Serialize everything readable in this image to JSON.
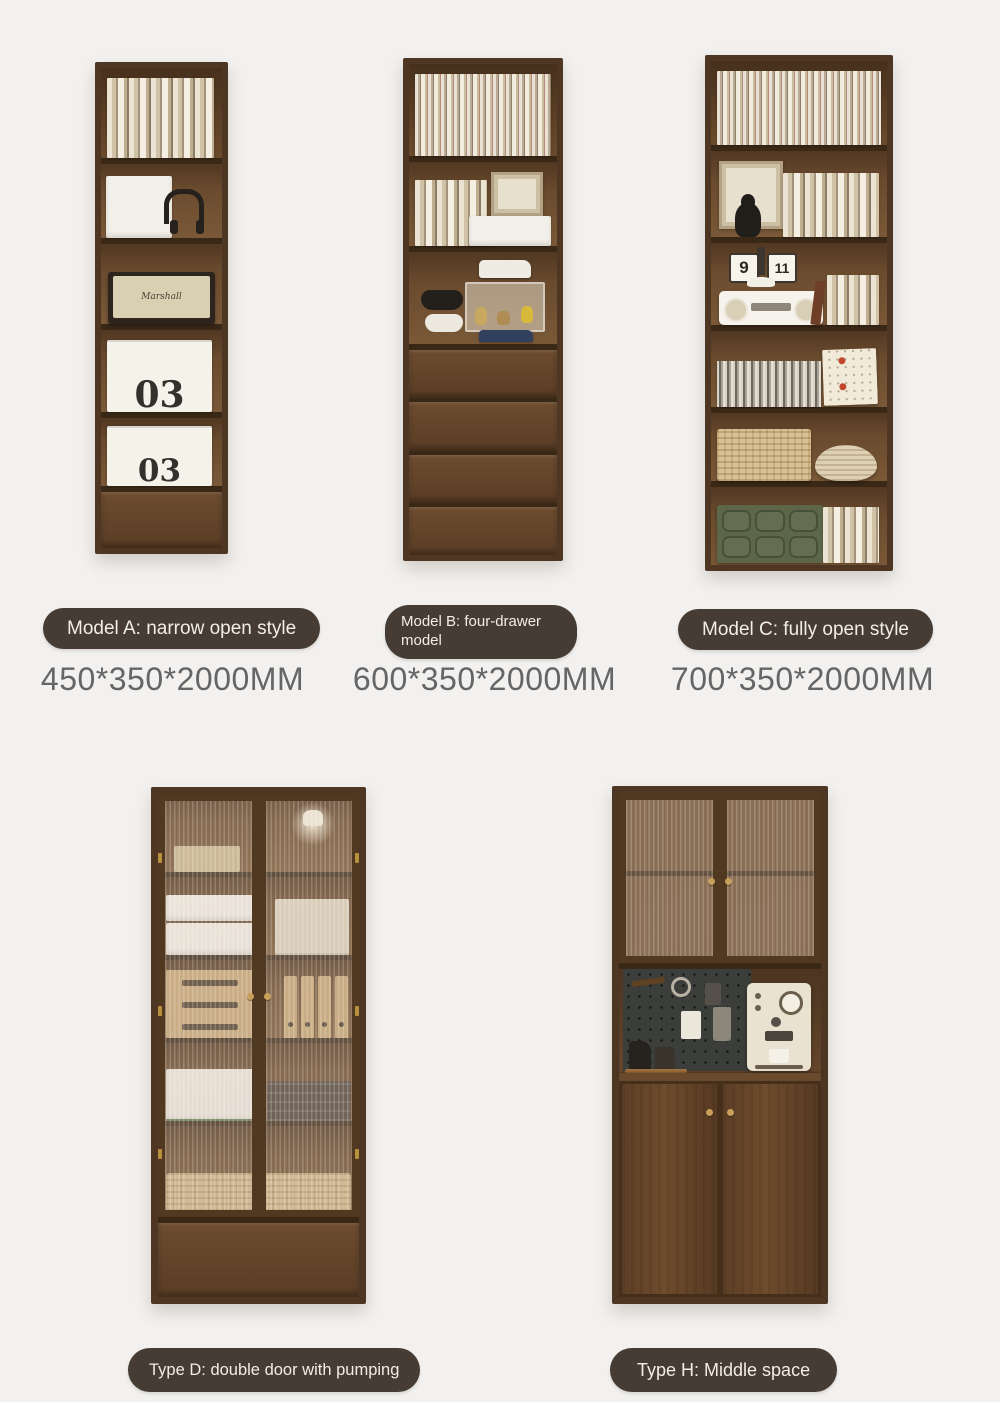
{
  "colors": {
    "background": "#f2f1ef",
    "pill_bg": "#463c33",
    "pill_text": "#f1ede7",
    "dimension_text": "#656565",
    "wood_frame": "#4e3622",
    "wood_interior": "#6f5034",
    "brass": "#c9a05a"
  },
  "products": [
    {
      "key": "model-a",
      "label": "Model A: narrow open style",
      "dimensions": "450*350*2000MM"
    },
    {
      "key": "model-b",
      "label": "Model B: four-drawer model",
      "dimensions": "600*350*2000MM"
    },
    {
      "key": "model-c",
      "label": "Model C: fully open style",
      "dimensions": "700*350*2000MM"
    },
    {
      "key": "type-d",
      "label": "Type D: double door with pumping",
      "dimensions": ""
    },
    {
      "key": "type-h",
      "label": "Type H: Middle space",
      "dimensions": ""
    }
  ],
  "decor": {
    "storage_box_label": "03",
    "flip_clock_hour": "9",
    "flip_clock_minute": "11",
    "speaker_brand": "Marshall"
  }
}
